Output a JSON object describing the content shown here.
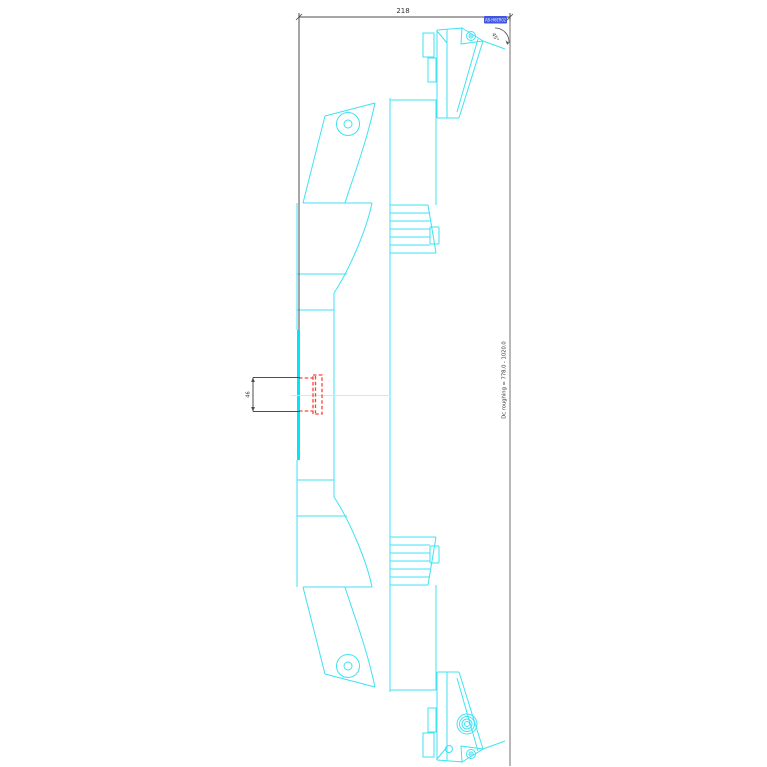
{
  "drawing": {
    "dimensions": {
      "length": "218",
      "height": "46",
      "angle": "45°"
    },
    "tool_badge": "AB-H6ER02",
    "dc_note": "Dc roughing = 778.0 - 1020.0"
  },
  "colors": {
    "geometry": "#3fe2f2",
    "geometry_bold": "#00e4f4",
    "centerline": "#ffff00",
    "insert_profile": "#ff4136",
    "dimension": "#4d4d4d",
    "badge_bg": "#4156e0",
    "badge_text": "#e8ecff"
  }
}
